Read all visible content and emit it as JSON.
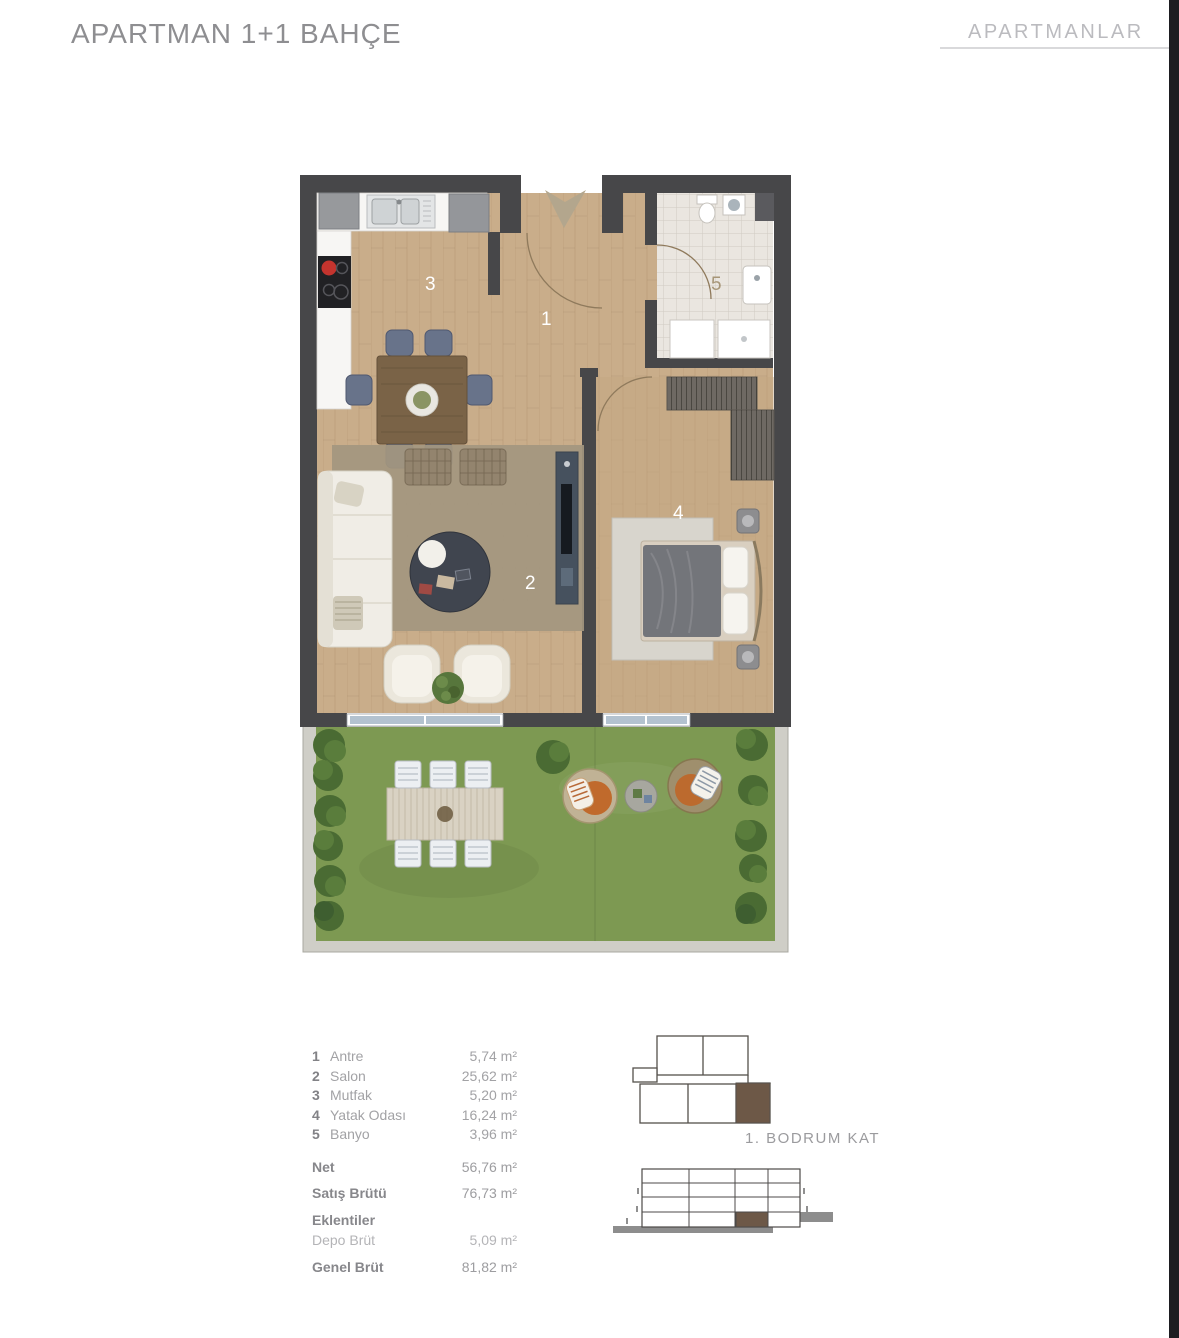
{
  "header": {
    "title": "APARTMAN 1+1 BAHÇE",
    "nav_label": "APARTMANLAR"
  },
  "plan": {
    "room_numbers": [
      {
        "num": "1",
        "room": "antre"
      },
      {
        "num": "2",
        "room": "salon"
      },
      {
        "num": "3",
        "room": "mutfak"
      },
      {
        "num": "4",
        "room": "yatak-odasi"
      },
      {
        "num": "5",
        "room": "banyo"
      }
    ],
    "entrance_arrow": "down"
  },
  "legend": {
    "rooms": [
      {
        "num": "1",
        "label": "Antre",
        "area": "5,74 m²"
      },
      {
        "num": "2",
        "label": "Salon",
        "area": "25,62 m²"
      },
      {
        "num": "3",
        "label": "Mutfak",
        "area": "5,20 m²"
      },
      {
        "num": "4",
        "label": "Yatak Odası",
        "area": "16,24 m²"
      },
      {
        "num": "5",
        "label": "Banyo",
        "area": "3,96 m²"
      }
    ],
    "totals": [
      {
        "label": "Net",
        "area": "56,76 m²"
      },
      {
        "label": "Satış Brütü",
        "area": "76,73 m²"
      },
      {
        "label": "Eklentiler",
        "area": ""
      },
      {
        "label": "Depo Brüt",
        "area": "5,09 m²"
      },
      {
        "label": "Genel Brüt",
        "area": "81,82 m²"
      }
    ]
  },
  "key_plan": {
    "caption": "1. BODRUM KAT"
  },
  "colors": {
    "wall": "#474749",
    "wood_floor": "#c9ad8a",
    "tile_floor": "#eae6e0",
    "grass": "#7d9952",
    "terrace_rim": "#cfcec7",
    "highlight_unit": "#6d5847",
    "entrance_arrow": "#b3a68d",
    "title_gray": "#8e8e91",
    "nav_gray": "#bbbbbf"
  }
}
